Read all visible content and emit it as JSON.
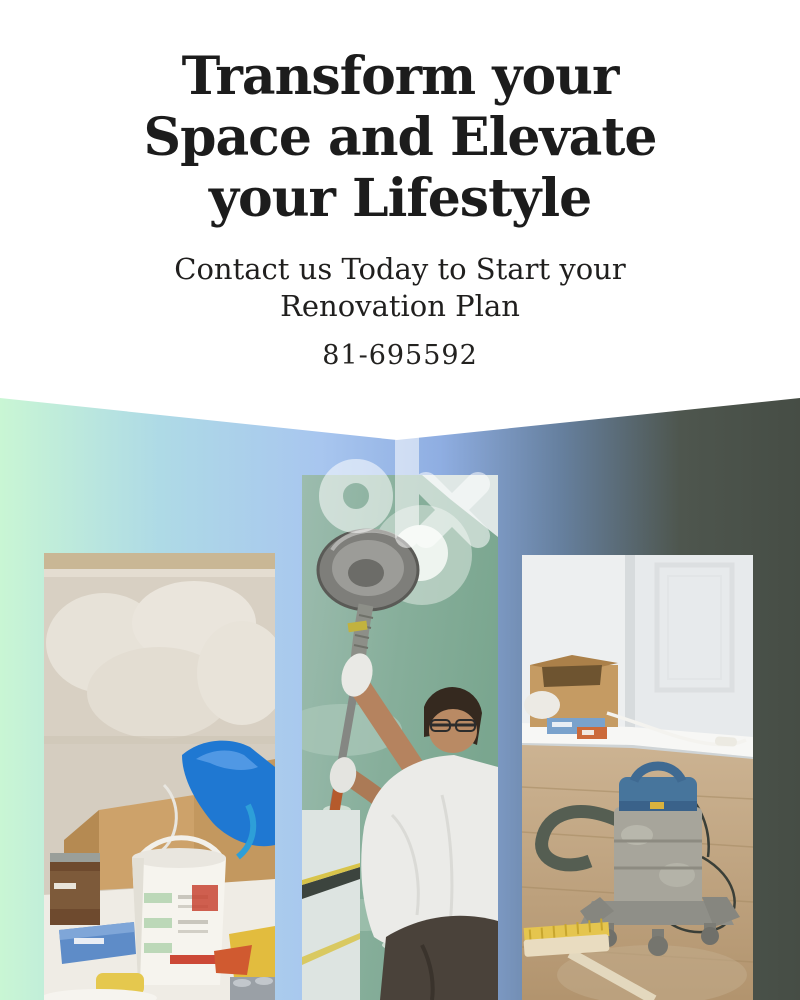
{
  "page": {
    "width_px": 800,
    "height_px": 1000,
    "background": "#ffffff"
  },
  "header": {
    "headline_lines": [
      "Transform your",
      "Space and Elevate",
      "your Lifestyle"
    ],
    "subtitle_lines": [
      "Contact us Today to Start your",
      "Renovation Plan"
    ],
    "phone": "81-695592",
    "text_color": "#1c1c1c"
  },
  "banner": {
    "gradient_colors": [
      "#c9f6d4",
      "#aedae6",
      "#a8c6ef",
      "#8faee2",
      "#66809f",
      "#4e564e",
      "#464d45"
    ],
    "notch_depth_px": 42
  },
  "watermark": {
    "brand": "olx",
    "color": "rgba(255,255,255,0.55)"
  },
  "photos": [
    {
      "description": "Renovation supplies: plastered beige wall, cardboard boxes, blue plastic sheet, white paint bucket, paint can, sponge and small boxes on a white surface"
    },
    {
      "description": "Worker in white t-shirt and glasses sanding a teal drywall ceiling with a long-reach circular sander"
    },
    {
      "description": "Dusty shop vacuum with hose on a wooden floor beside cardboard boxes and a push broom"
    }
  ]
}
